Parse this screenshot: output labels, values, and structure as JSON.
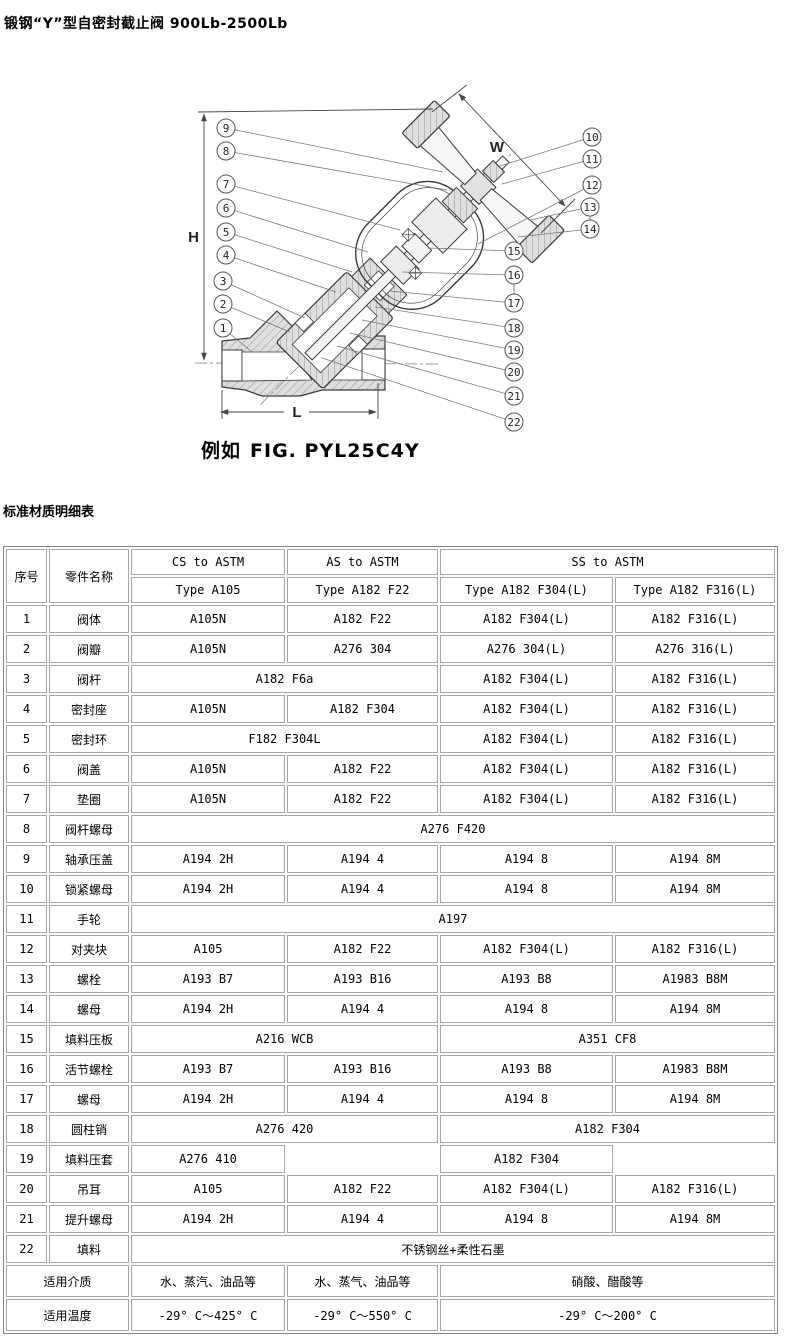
{
  "page": {
    "title": "锻钢“Y”型自密封截止阀 900Lb-2500Lb",
    "section_heading": "标准材质明细表"
  },
  "figure": {
    "caption_prefix": "例如",
    "caption_code": "FIG. PYL25C4Y"
  },
  "diagram": {
    "dims": {
      "h": "H",
      "l": "L",
      "w": "W"
    },
    "callouts": [
      "1",
      "2",
      "3",
      "4",
      "5",
      "6",
      "7",
      "8",
      "9",
      "10",
      "11",
      "12",
      "13",
      "14",
      "15",
      "16",
      "17",
      "18",
      "19",
      "20",
      "21",
      "22"
    ]
  },
  "table": {
    "header": {
      "col_index": "序号",
      "col_part": "零件名称",
      "group_cs": "CS to ASTM",
      "group_as": "AS to ASTM",
      "group_ss": "SS to ASTM",
      "type_cs": "Type A105",
      "type_as": "Type A182 F22",
      "type_ss304": "Type A182 F304(L)",
      "type_ss316": "Type A182 F316(L)"
    },
    "rows": [
      {
        "no": "1",
        "part": "阀体",
        "cells": [
          {
            "text": "A105N"
          },
          {
            "text": "A182 F22"
          },
          {
            "text": "A182 F304(L)"
          },
          {
            "text": "A182 F316(L)"
          }
        ]
      },
      {
        "no": "2",
        "part": "阀瓣",
        "cells": [
          {
            "text": "A105N"
          },
          {
            "text": "A276 304"
          },
          {
            "text": "A276 304(L)"
          },
          {
            "text": "A276 316(L)"
          }
        ]
      },
      {
        "no": "3",
        "part": "阀杆",
        "cells": [
          {
            "text": "A182 F6a",
            "span": 2
          },
          {
            "text": "A182 F304(L)"
          },
          {
            "text": "A182 F316(L)"
          }
        ]
      },
      {
        "no": "4",
        "part": "密封座",
        "cells": [
          {
            "text": "A105N"
          },
          {
            "text": "A182 F304"
          },
          {
            "text": "A182 F304(L)"
          },
          {
            "text": "A182 F316(L)"
          }
        ]
      },
      {
        "no": "5",
        "part": "密封环",
        "cells": [
          {
            "text": "F182 F304L",
            "span": 2
          },
          {
            "text": "A182 F304(L)"
          },
          {
            "text": "A182 F316(L)"
          }
        ]
      },
      {
        "no": "6",
        "part": "阀盖",
        "cells": [
          {
            "text": "A105N"
          },
          {
            "text": "A182 F22"
          },
          {
            "text": "A182 F304(L)"
          },
          {
            "text": "A182 F316(L)"
          }
        ]
      },
      {
        "no": "7",
        "part": "垫圈",
        "cells": [
          {
            "text": "A105N"
          },
          {
            "text": "A182 F22"
          },
          {
            "text": "A182 F304(L)"
          },
          {
            "text": "A182 F316(L)"
          }
        ]
      },
      {
        "no": "8",
        "part": "阀杆螺母",
        "cells": [
          {
            "text": "A276 F420",
            "span": 4
          }
        ]
      },
      {
        "no": "9",
        "part": "轴承压盖",
        "cells": [
          {
            "text": "A194 2H"
          },
          {
            "text": "A194 4"
          },
          {
            "text": "A194 8"
          },
          {
            "text": "A194 8M"
          }
        ]
      },
      {
        "no": "10",
        "part": "锁紧螺母",
        "cells": [
          {
            "text": "A194 2H"
          },
          {
            "text": "A194 4"
          },
          {
            "text": "A194 8"
          },
          {
            "text": "A194 8M"
          }
        ]
      },
      {
        "no": "11",
        "part": "手轮",
        "cells": [
          {
            "text": "A197",
            "span": 4
          }
        ]
      },
      {
        "no": "12",
        "part": "对夹块",
        "cells": [
          {
            "text": "A105"
          },
          {
            "text": "A182 F22"
          },
          {
            "text": "A182 F304(L)"
          },
          {
            "text": "A182 F316(L)"
          }
        ]
      },
      {
        "no": "13",
        "part": "螺栓",
        "cells": [
          {
            "text": "A193 B7"
          },
          {
            "text": "A193 B16"
          },
          {
            "text": "A193 B8"
          },
          {
            "text": "A1983 B8M"
          }
        ]
      },
      {
        "no": "14",
        "part": "螺母",
        "cells": [
          {
            "text": "A194 2H"
          },
          {
            "text": "A194 4"
          },
          {
            "text": "A194 8"
          },
          {
            "text": "A194 8M"
          }
        ]
      },
      {
        "no": "15",
        "part": "填料压板",
        "cells": [
          {
            "text": "A216 WCB",
            "span": 2
          },
          {
            "text": "A351 CF8",
            "span": 2
          }
        ]
      },
      {
        "no": "16",
        "part": "活节螺栓",
        "cells": [
          {
            "text": "A193 B7"
          },
          {
            "text": "A193 B16"
          },
          {
            "text": "A193 B8"
          },
          {
            "text": "A1983 B8M"
          }
        ]
      },
      {
        "no": "17",
        "part": "螺母",
        "cells": [
          {
            "text": "A194 2H"
          },
          {
            "text": "A194 4"
          },
          {
            "text": "A194 8"
          },
          {
            "text": "A194 8M"
          }
        ]
      },
      {
        "no": "18",
        "part": "圆柱销",
        "cells": [
          {
            "text": "A276 420",
            "span": 2
          },
          {
            "text": "A182 F304",
            "span": 2
          }
        ]
      },
      {
        "no": "19",
        "part": "填料压套",
        "cells": [
          {
            "text": "A276 410"
          },
          {
            "text": ""
          },
          {
            "text": "A182 F304"
          },
          {
            "text": ""
          }
        ]
      },
      {
        "no": "20",
        "part": "吊耳",
        "cells": [
          {
            "text": "A105"
          },
          {
            "text": "A182 F22"
          },
          {
            "text": "A182 F304(L)"
          },
          {
            "text": "A182 F316(L)"
          }
        ]
      },
      {
        "no": "21",
        "part": "提升螺母",
        "cells": [
          {
            "text": "A194 2H"
          },
          {
            "text": "A194 4"
          },
          {
            "text": "A194 8"
          },
          {
            "text": "A194 8M"
          }
        ]
      },
      {
        "no": "22",
        "part": "填料",
        "cells": [
          {
            "text": "不锈钢丝+柔性石墨",
            "span": 4
          }
        ]
      }
    ],
    "footer": [
      {
        "label": "适用介质",
        "cells": [
          {
            "text": "水、蒸汽、油品等"
          },
          {
            "text": "水、蒸气、油品等"
          },
          {
            "text": "硝酸、醋酸等",
            "span": 2
          }
        ]
      },
      {
        "label": "适用温度",
        "cells": [
          {
            "text": "-29° C～425° C"
          },
          {
            "text": "-29° C～550° C"
          },
          {
            "text": "-29° C～200° C",
            "span": 2
          }
        ]
      }
    ]
  }
}
